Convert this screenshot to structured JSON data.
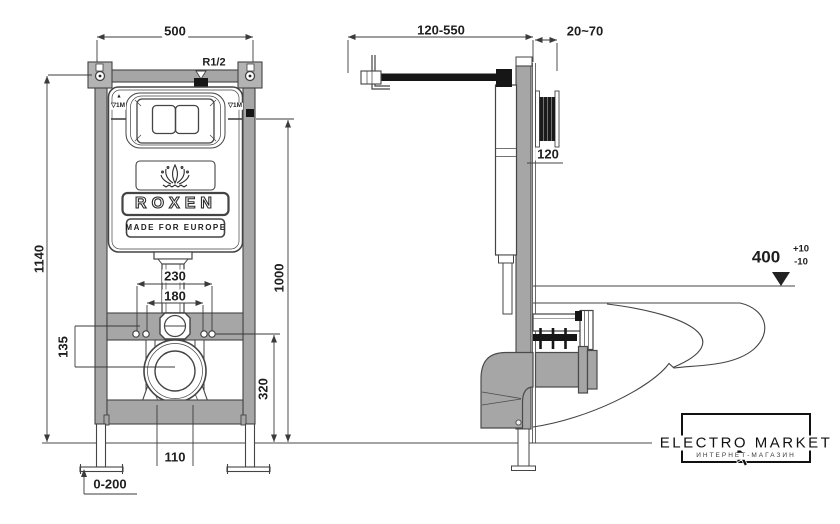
{
  "front_view": {
    "width": "500",
    "inlet_thread": "R1/2",
    "total_height": "1140",
    "actuation_height": "1000",
    "fixing_outer": "230",
    "fixing_inner": "180",
    "side_offset": "135",
    "outlet_height": "320",
    "outlet_spacing": "110",
    "feet_adjust": "0-200",
    "level_mark_arrow": "▲",
    "level_mark_left": "▽1M",
    "level_mark_right": "▽1M"
  },
  "side_view": {
    "inlet_depth_range": "120-550",
    "finish_thickness": "20~70",
    "plate_offset": "120",
    "bowl_height": "400",
    "bowl_height_plus": "+10",
    "bowl_height_minus": "-10"
  },
  "brand": {
    "name": "ROXEN",
    "tagline": "MADE FOR EUROPE",
    "crown_icon": "lotus-crown"
  },
  "watermark": {
    "title": "ELECTRO MARKET",
    "subtitle": "ИНТЕРНЕТ-МАГАЗИН",
    "cursor_icon": "mouse-pointer"
  },
  "colors": {
    "line": "#3b3b3b",
    "metal_fill": "#a6a6a6",
    "black_fill": "#161616",
    "background": "#ffffff"
  }
}
